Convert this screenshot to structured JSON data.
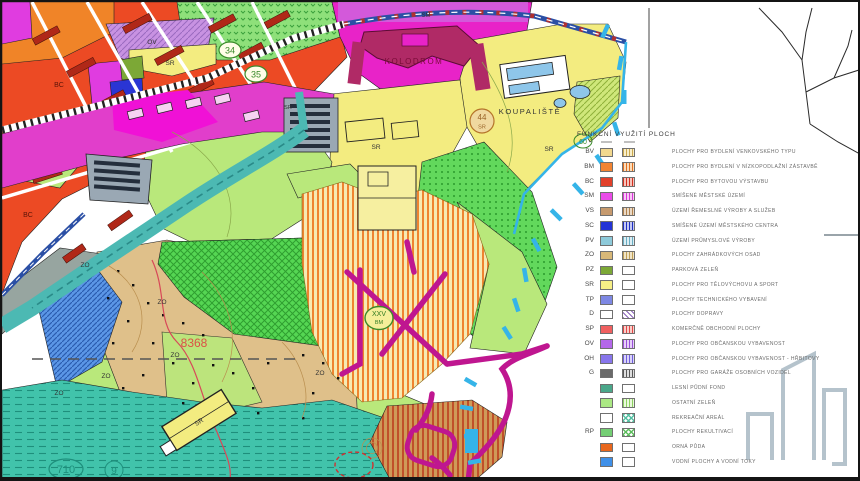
{
  "map": {
    "labels": [
      {
        "text": "OV"
      },
      {
        "text": "SR"
      },
      {
        "text": "34"
      },
      {
        "text": "35"
      },
      {
        "text": "SM"
      },
      {
        "text": "KOLODROM"
      },
      {
        "text": "KOUPALIŠTĚ"
      },
      {
        "text": "44"
      },
      {
        "text": "SR"
      },
      {
        "text": "SR"
      },
      {
        "text": "SR"
      },
      {
        "text": "60"
      },
      {
        "text": "BC"
      },
      {
        "text": "BC"
      },
      {
        "text": "ZO"
      },
      {
        "text": "ZO"
      },
      {
        "text": "ZO"
      },
      {
        "text": "ZO"
      },
      {
        "text": "ZO"
      },
      {
        "text": "ZO"
      },
      {
        "text": "8368"
      },
      {
        "text": "XXV"
      },
      {
        "text": "BM"
      },
      {
        "text": "710"
      },
      {
        "text": "9"
      },
      {
        "text": "SR"
      },
      {
        "text": "SR"
      }
    ],
    "colors": {
      "red": "#ec4a24",
      "orange": "#f08428",
      "magenta_band": "#e13ecb",
      "magenta_bright": "#f011d6",
      "kolodrom": "#e823c8",
      "kolodrom_bldg": "#b02a66",
      "purple_ov": "#c892e2",
      "yellow": "#f3ec80",
      "green_light": "#b9e87b",
      "tan": "#dfc08a",
      "teal_river": "#4cb9b3",
      "teal_bottom": "#41c3ab",
      "blue_sc": "#2a35d4",
      "gray_g": "#9aa8b4",
      "road_blue": "#2b4fa5",
      "magenta_road": "#bf1690",
      "cyan_tick": "#35b4e8",
      "logo_gray": "#b5c3cc",
      "pool_blue": "#8ec6ea"
    }
  },
  "legend": {
    "title": "FUNKČNÍ VYUŽITÍ PLOCH",
    "rows": [
      {
        "code": "BV",
        "color": "#f2d88e",
        "pattern": "stripes",
        "pcolor": "#caa84e",
        "tint": "#f8eeca",
        "label": "PLOCHY PRO BYDLENÍ VENKOVSKÉHO TYPU"
      },
      {
        "code": "BM",
        "color": "#f28432",
        "pattern": "stripes",
        "pcolor": "#e07020",
        "tint": "#fbdcba",
        "label": "PLOCHY PRO BYDLENÍ V NÍZKOPODLAŽNÍ ZÁSTAVBĚ"
      },
      {
        "code": "BC",
        "color": "#e2402a",
        "pattern": "stripes",
        "pcolor": "#d23020",
        "tint": "#f6c3ba",
        "label": "PLOCHY PRO BYTOVOU VÝSTAVBU"
      },
      {
        "code": "SM",
        "color": "#ea4ce8",
        "pattern": "stripes",
        "pcolor": "#d838d6",
        "tint": "#f8c8f6",
        "label": "SMÍŠENÉ MĚSTSKÉ ÚZEMÍ"
      },
      {
        "code": "VS",
        "color": "#c69a6e",
        "pattern": "stripes",
        "pcolor": "#b0824e",
        "tint": "#ead9c6",
        "label": "ÚZEMÍ ŘEMESLNÉ VÝROBY A SLUŽEB"
      },
      {
        "code": "SC",
        "color": "#2434d6",
        "pattern": "stripes",
        "pcolor": "#2030c0",
        "tint": "#c4c8f2",
        "label": "SMÍŠENÉ ÚZEMÍ MĚSTSKÉHO CENTRA"
      },
      {
        "code": "PV",
        "color": "#8ecada",
        "pattern": "stripes",
        "pcolor": "#6aaec2",
        "tint": "#dcedf3",
        "label": "ÚZEMÍ PRŮMYSLOVÉ VÝROBY"
      },
      {
        "code": "ZO",
        "color": "#d8b878",
        "pattern": "stripes",
        "pcolor": "#c0a058",
        "tint": "#f0e4c6",
        "label": "PLOCHY ZAHRÁDKOVÝCH OSAD"
      },
      {
        "code": "PZ",
        "color": "#7ca836",
        "pattern": "none",
        "pcolor": "",
        "tint": "",
        "label": "PARKOVÁ ZELEŇ"
      },
      {
        "code": "SR",
        "color": "#f6ef86",
        "pattern": "none",
        "pcolor": "",
        "tint": "",
        "label": "PLOCHY PRO TĚLOVÝCHOVU A SPORT"
      },
      {
        "code": "TP",
        "color": "#7e88e4",
        "pattern": "none",
        "pcolor": "",
        "tint": "",
        "label": "PLOCHY TECHNICKÉHO VYBAVENÍ"
      },
      {
        "code": "D",
        "color": "#ffffff",
        "pattern": "diag",
        "pcolor": "#8a62b8",
        "tint": "",
        "label": "PLOCHY DOPRAVY"
      },
      {
        "code": "SP",
        "color": "#f06060",
        "pattern": "stripes",
        "pcolor": "#e04848",
        "tint": "#facfca",
        "label": "KOMERČNĚ OBCHODNÍ PLOCHY"
      },
      {
        "code": "OV",
        "color": "#b468ea",
        "pattern": "stripes",
        "pcolor": "#9a50d8",
        "tint": "#e7d0f8",
        "label": "PLOCHY PRO OBČANSKOU VYBAVENOST"
      },
      {
        "code": "OH",
        "color": "#8876ec",
        "pattern": "stripes",
        "pcolor": "#7060dc",
        "tint": "#dad3f9",
        "label": "PLOCHY PRO OBČANSKOU VYBAVENOST - HŘBITOVY"
      },
      {
        "code": "G",
        "color": "#6a6a6a",
        "pattern": "stripes",
        "pcolor": "#585858",
        "tint": "#dedede",
        "label": "PLOCHY PRO GARÁŽE OSOBNÍCH VOZIDEL"
      },
      {
        "code": "",
        "color": "#4aa78a",
        "pattern": "none",
        "pcolor": "",
        "tint": "",
        "label": "LESNÍ PŮDNÍ FOND"
      },
      {
        "code": "",
        "color": "#abe884",
        "pattern": "stripes",
        "pcolor": "#8cd062",
        "tint": "#eaf9dc",
        "label": "OSTATNÍ ZELEŇ"
      },
      {
        "code": "",
        "color": "#ffffff",
        "pattern": "check",
        "pcolor": "#54bfa2",
        "tint": "",
        "label": "REKREAČNÍ AREÁL"
      },
      {
        "code": "RP",
        "color": "#74ce74",
        "pattern": "check",
        "pcolor": "#5cbc5c",
        "tint": "",
        "label": "PLOCHY REKULTIVACÍ"
      },
      {
        "code": "",
        "color": "#e8671d",
        "pattern": "none",
        "pcolor": "",
        "tint": "",
        "label": "ORNÁ PŮDA"
      },
      {
        "code": "",
        "color": "#3f90e8",
        "pattern": "none",
        "pcolor": "",
        "tint": "",
        "label": "VODNÍ PLOCHY A VODNÍ TOKY"
      }
    ]
  }
}
